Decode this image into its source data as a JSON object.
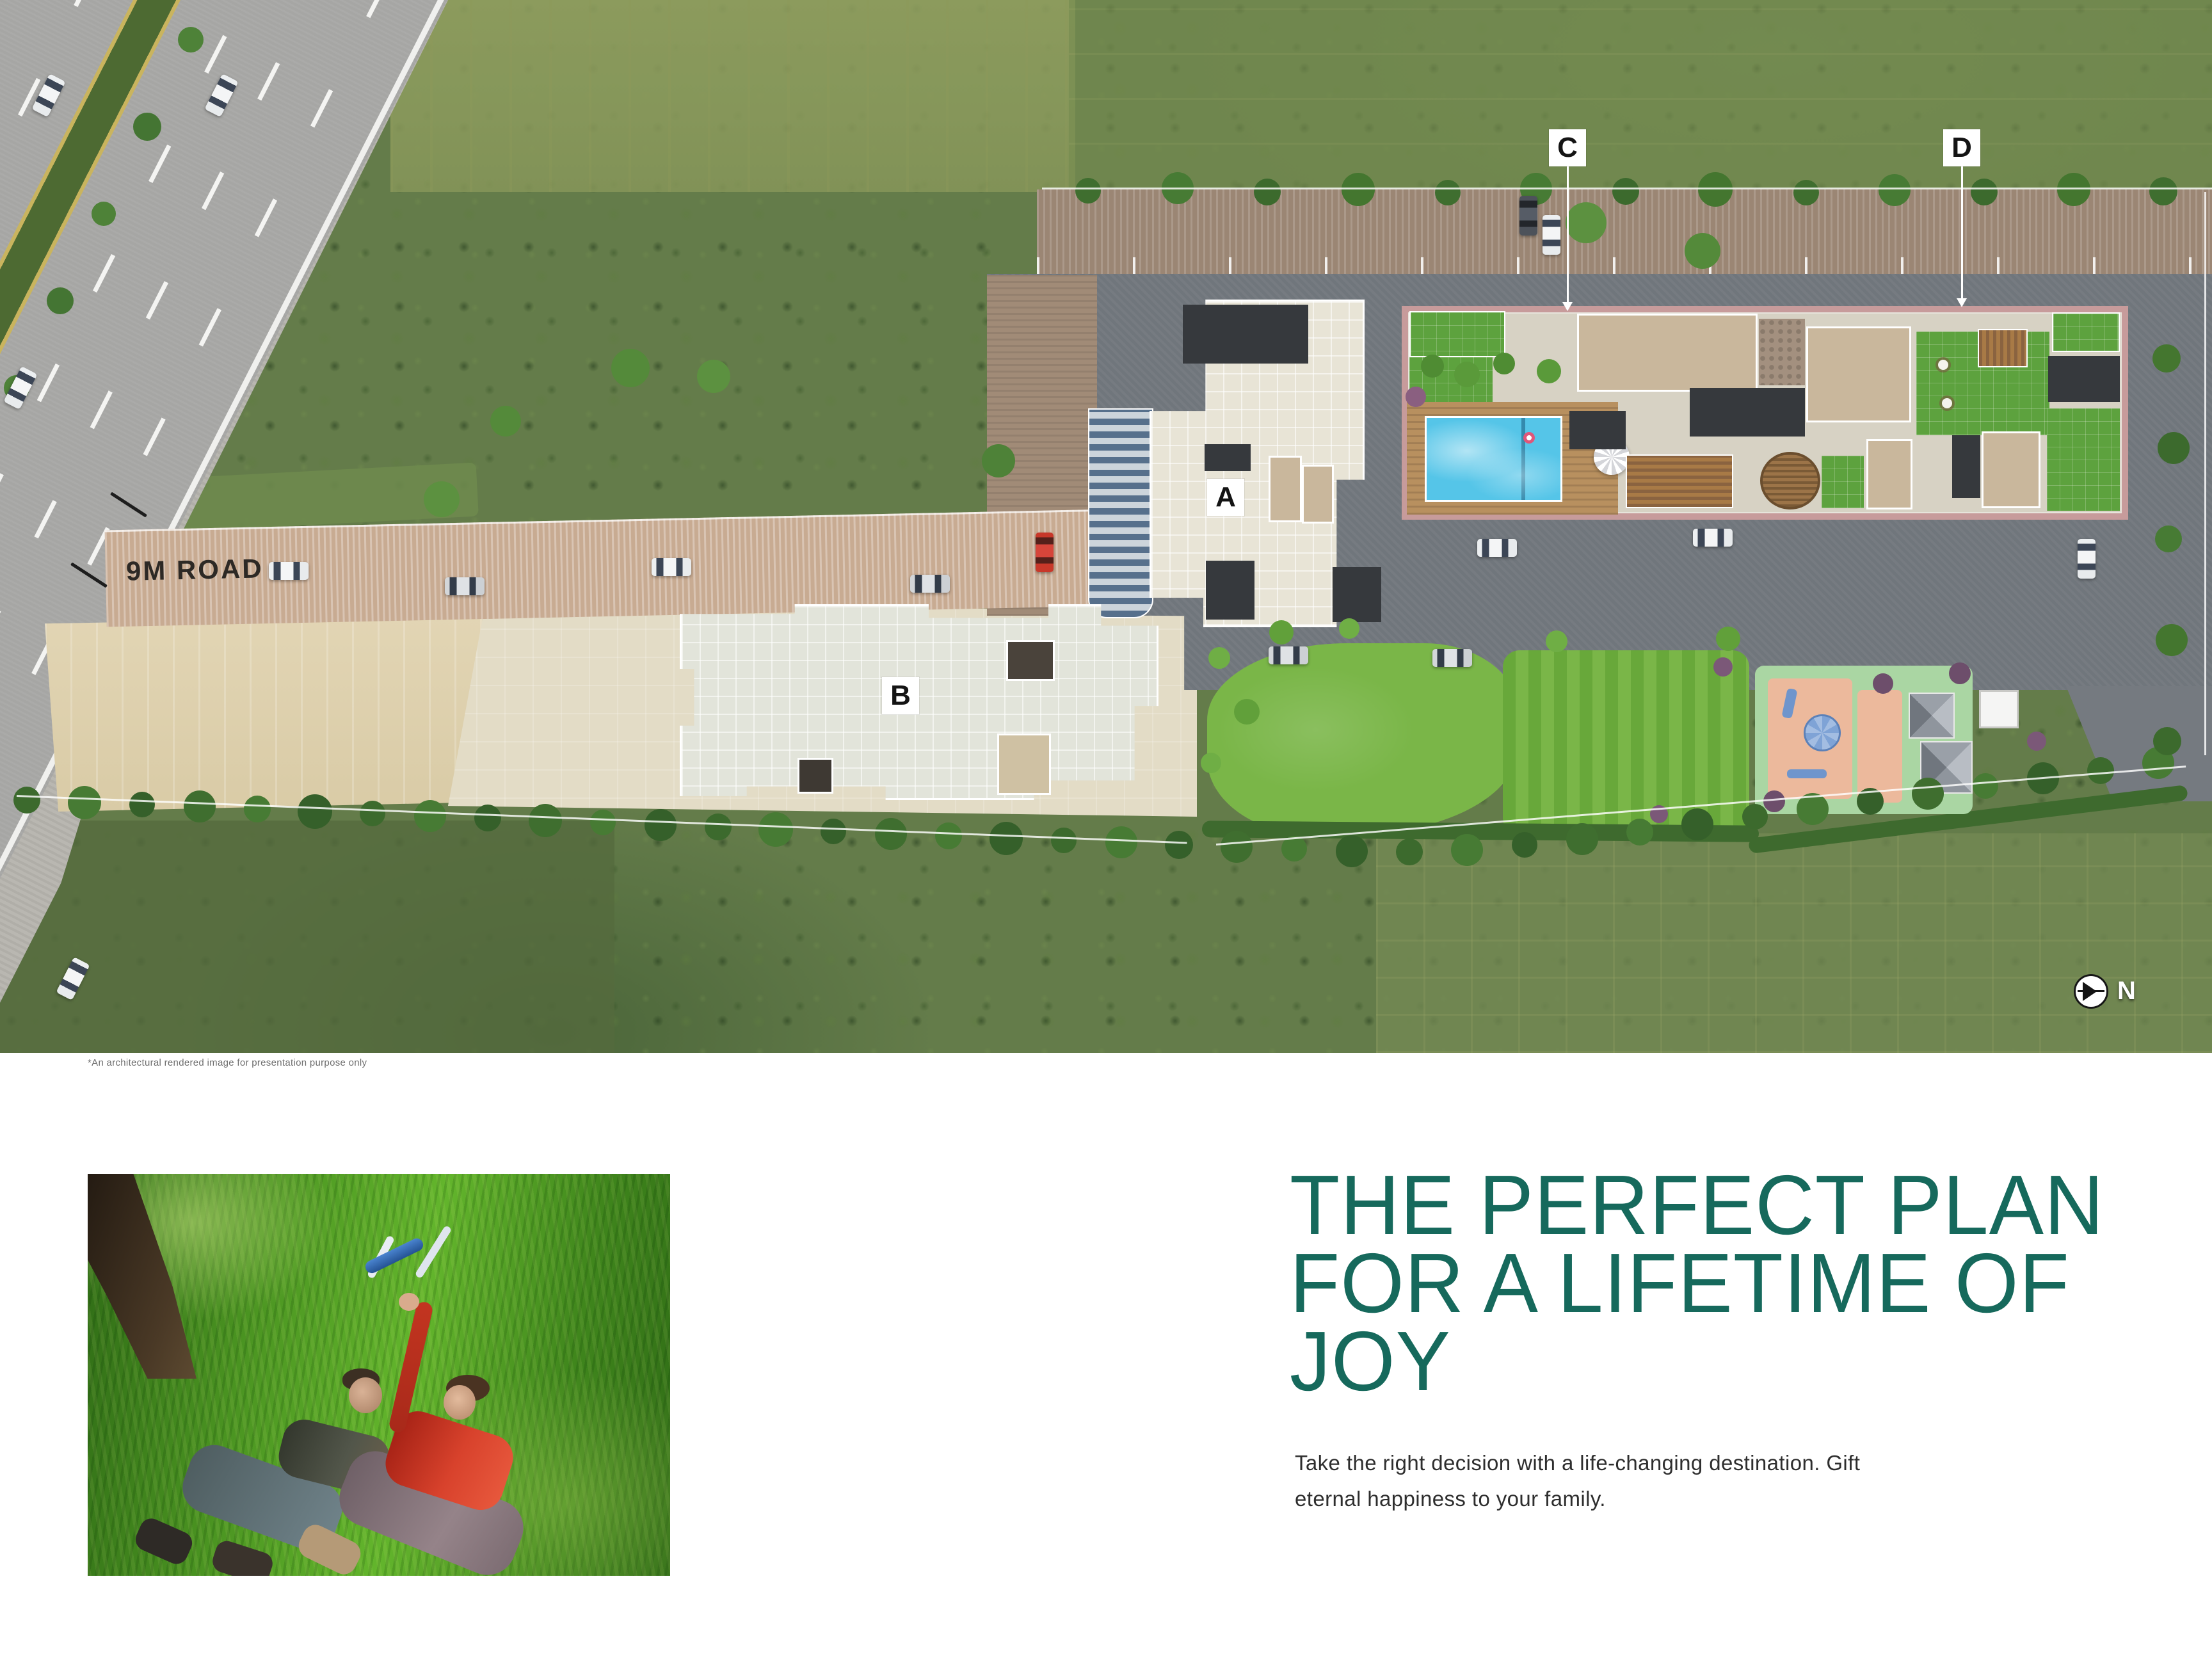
{
  "plan": {
    "road_label": "9M ROAD",
    "labels": {
      "a": "A",
      "b": "B",
      "c": "C",
      "d": "D"
    },
    "north_label": "N",
    "disclaimer": "*An architectural rendered image for presentation purpose only"
  },
  "copy": {
    "headline_line1": "THE PERFECT PLAN",
    "headline_line2": "FOR A LIFETIME OF JOY",
    "body_line1": "Take the right decision with a life-changing destination. Gift",
    "body_line2": "eternal happiness to your family."
  },
  "photo": {
    "alt": "Two children lying on a grassy lawn flying a toy airplane"
  },
  "colors": {
    "headline_teal": "#16695C",
    "pool_blue": "#55C5E8",
    "lawn_green": "#74B347",
    "path_pink": "#C79B9B",
    "label_bg": "#FFFFFF",
    "label_text": "#141414"
  }
}
